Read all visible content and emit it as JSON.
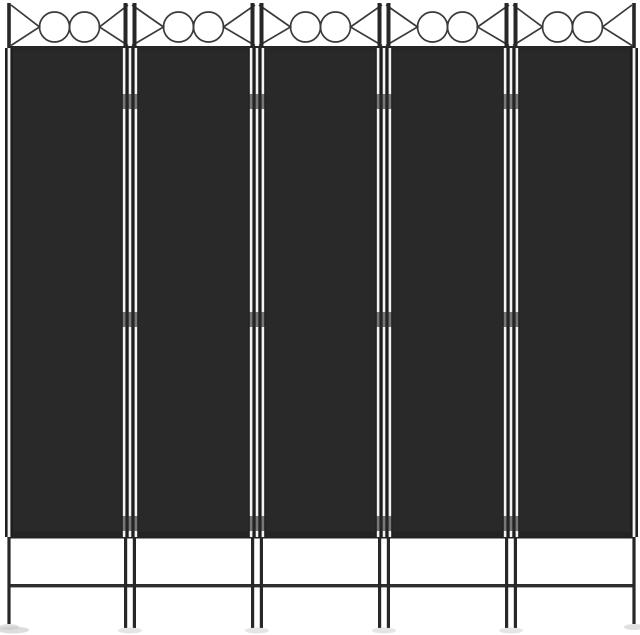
{
  "subject": {
    "type": "product-photo",
    "description": "Black 5-panel folding room divider privacy screen with a slim metal frame; each panel is topped by a decorative motif of two open circles flanked by triangle scrolls between the frame poles; panels are joined by hinged double poles that extend down into slender legs connected by a low crossbar",
    "panel_count": 5,
    "circles_per_panel": 2,
    "triangles_per_panel": 2,
    "hinges_per_junction": 3
  },
  "colors": {
    "background": "#ffffff",
    "fabric": "#292929",
    "fabric_edge": "#1f1f1f",
    "top_rail": "#262626",
    "bottom_rail": "#232323",
    "leg_crossbar": "#2e2e2e",
    "pole_dark": "#272727",
    "pole_base": "#1e1e1e",
    "pole_highlight": "#f3f3f3",
    "ornament_stroke": "#3a3a3a",
    "hinge": "#2a2a2a",
    "floor_shadow": "#c6c6c6"
  },
  "canvas": {
    "width": 640,
    "height": 635
  }
}
